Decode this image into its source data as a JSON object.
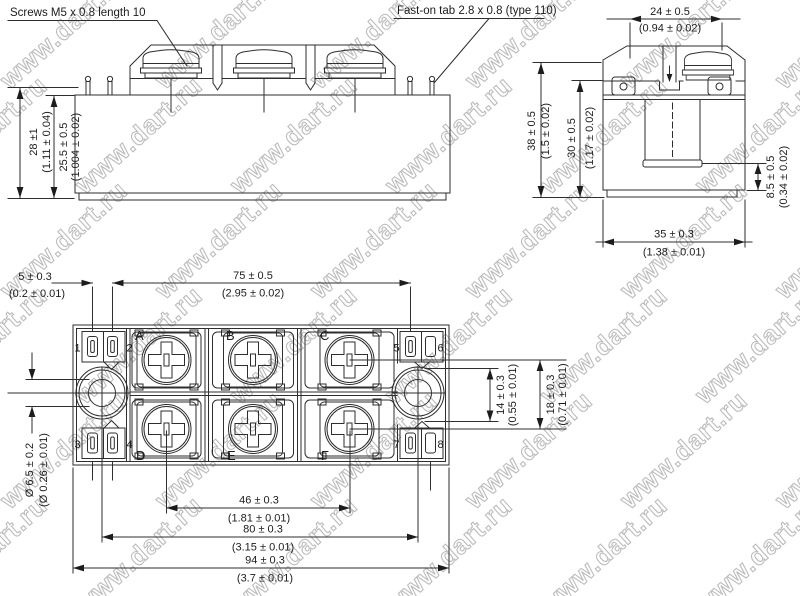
{
  "watermark": {
    "text": "www.dart.ru",
    "color": "#bcbcbc"
  },
  "colors": {
    "background": "#ffffff",
    "line": "#2e2e2e",
    "text": "#1c1c1c"
  },
  "callouts": {
    "screws": "Screws M5 x 0.8 length 10",
    "faston": "Fast-on tab 2.8 x 0.8 (type 110)"
  },
  "dimensions": {
    "d28": {
      "mm": "28 ±1",
      "inch": "(1.11 ± 0.04)"
    },
    "d25_5": {
      "mm": "25.5 ± 0.5",
      "inch": "(1.004 ± 0.02)"
    },
    "d24": {
      "mm": "24 ± 0.5",
      "inch": "(0.94 ± 0.02)"
    },
    "d38": {
      "mm": "38 ± 0.5",
      "inch": "(1.5 ± 0.02)"
    },
    "d30": {
      "mm": "30 ± 0.5",
      "inch": "(1.17 ± 0.02)"
    },
    "d8_5": {
      "mm": "8.5 ± 0.5",
      "inch": "(0.34 ± 0.02)"
    },
    "d35": {
      "mm": "35 ± 0.3",
      "inch": "(1.38 ± 0.01)"
    },
    "d5": {
      "mm": "5 ± 0.3",
      "inch": "(0.2 ± 0.01)"
    },
    "d75": {
      "mm": "75 ± 0.5",
      "inch": "(2.95 ± 0.02)"
    },
    "d14": {
      "mm": "14 ± 0.3",
      "inch": "(0.55 ± 0.01)"
    },
    "d18": {
      "mm": "18 ± 0.3",
      "inch": "(0.71 ± 0.01)"
    },
    "d6_5": {
      "mm": "Ø 6.5 ± 0.2",
      "inch": "(Ø 0.26 ± 0.01)"
    },
    "d46": {
      "mm": "46 ± 0.3",
      "inch": "(1.81 ± 0.01)"
    },
    "d80": {
      "mm": "80 ± 0.3",
      "inch": "(3.15 ± 0.01)"
    },
    "d94": {
      "mm": "94 ± 0.3",
      "inch": "(3.7 ± 0.01)"
    }
  },
  "terminals": [
    "A",
    "B",
    "C",
    "D",
    "E",
    "F"
  ],
  "tabs": [
    "1",
    "2",
    "3",
    "4",
    "5",
    "6",
    "7",
    "8"
  ]
}
